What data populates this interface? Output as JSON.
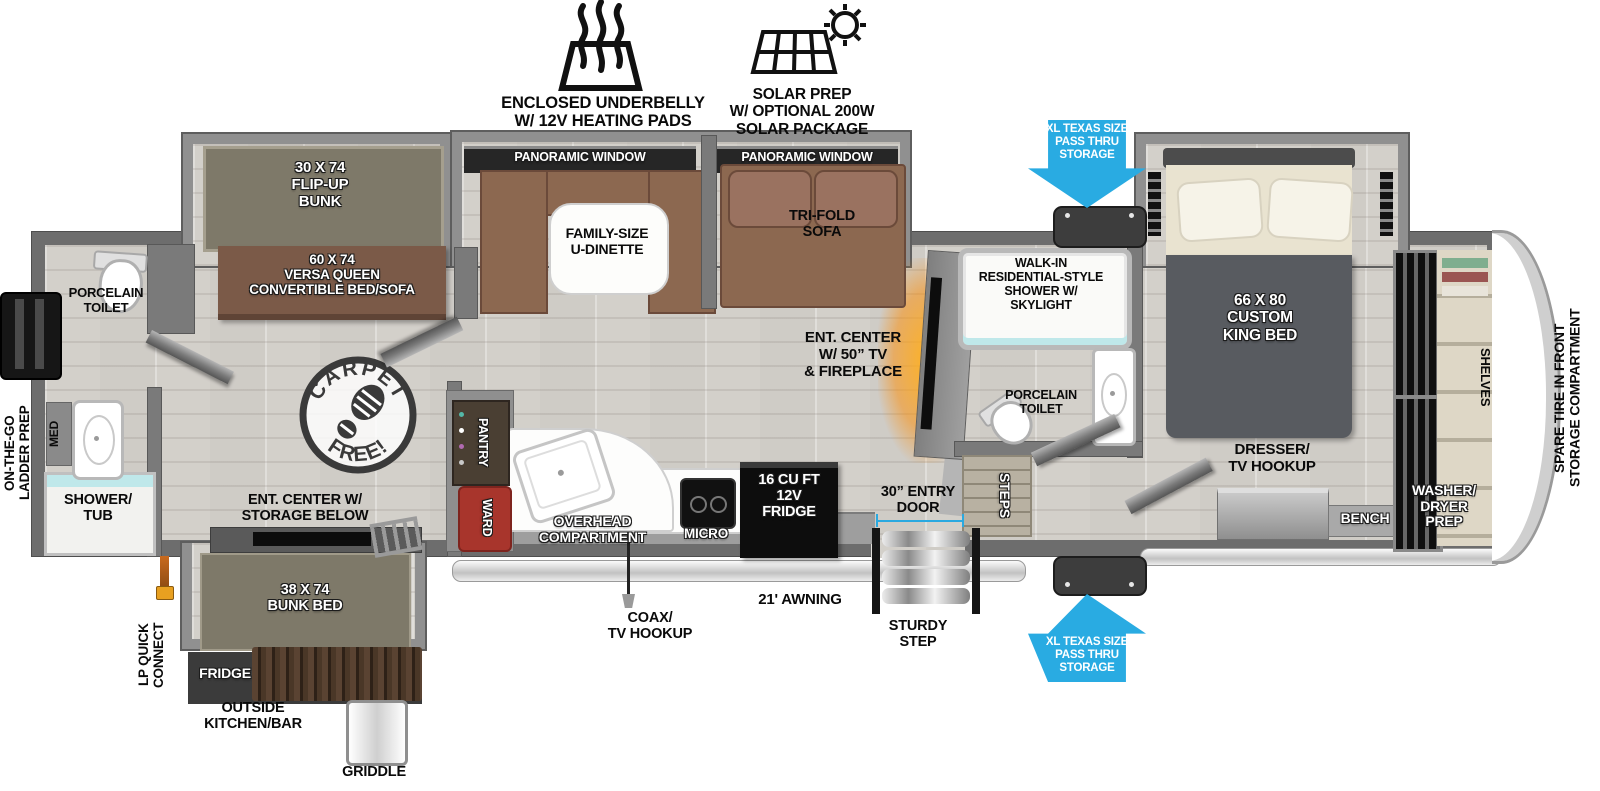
{
  "title": "Fifth wheel travel trailer floorplan",
  "colors": {
    "arrow_blue": "#29ABE2",
    "dimension_blue": "#2AA9E0",
    "sofa_brown": "#8C6850",
    "bed_brown": "#7B5A48",
    "bunk_olive": "#7E7969",
    "wall_gray": "#6D6D6D",
    "appliance_black": "#111111",
    "ward_red": "#A8352C",
    "fireplace_orange": "#FF9C00"
  },
  "callouts": {
    "underbelly": "ENCLOSED UNDERBELLY\nW/ 12V HEATING PADS",
    "solar": "SOLAR PREP\nW/ OPTIONAL 200W\nSOLAR PACKAGE",
    "pass_thru_top": "XL TEXAS SIZE\nPASS THRU\nSTORAGE",
    "pass_thru_bottom": "XL TEXAS SIZE\nPASS THRU\nSTORAGE",
    "spare_tire": "SPARE TIRE IN FRONT\nSTORAGE COMPARTMENT",
    "ladder_prep": "ON-THE-GO\nLADDER PREP",
    "lp_quick_connect": "LP QUICK\nCONNECT",
    "coax": "COAX/\nTV HOOKUP",
    "awning": "21' AWNING",
    "entry_door": "30” ENTRY\nDOOR",
    "sturdy_step": "STURDY\nSTEP",
    "outside_kitchen": "OUTSIDE\nKITCHEN/BAR",
    "griddle": "GRIDDLE",
    "fridge_outside": "FRIDGE"
  },
  "interior": {
    "flip_up_bunk": "30 X 74\nFLIP-UP\nBUNK",
    "versa_queen": "60 X 74\nVERSA QUEEN\nCONVERTIBLE BED/SOFA",
    "panoramic_window_1": "PANORAMIC WINDOW",
    "panoramic_window_2": "PANORAMIC WINDOW",
    "u_dinette": "FAMILY-SIZE\nU-DINETTE",
    "tri_fold_sofa": "TRI-FOLD\nSOFA",
    "ent_center_tv": "ENT. CENTER\nW/ 50” TV\n& FIREPLACE",
    "walk_in_shower": "WALK-IN\nRESIDENTIAL-STYLE\nSHOWER W/\nSKYLIGHT",
    "porcelain_toilet_mid": "PORCELAIN\nTOILET",
    "porcelain_toilet_rear": "PORCELAIN\nTOILET",
    "steps": "STEPS",
    "king_bed": "66 X 80\nCUSTOM\nKING BED",
    "dresser": "DRESSER/\nTV HOOKUP",
    "bench": "BENCH",
    "shelves": "SHELVES",
    "washer_dryer": "WASHER/\nDRYER\nPREP",
    "med": "MED",
    "shower_tub": "SHOWER/\nTUB",
    "pantry": "PANTRY",
    "ward": "WARD",
    "overhead": "OVERHEAD\nCOMPARTMENT",
    "micro": "MICRO",
    "fridge_12v": "16 CU FT\n12V\nFRIDGE",
    "ent_center_storage": "ENT. CENTER W/\nSTORAGE BELOW",
    "bunk_bed": "38 X 74\nBUNK BED",
    "carpet_free_top": "CARPET",
    "carpet_free_bottom": "FREE!"
  }
}
